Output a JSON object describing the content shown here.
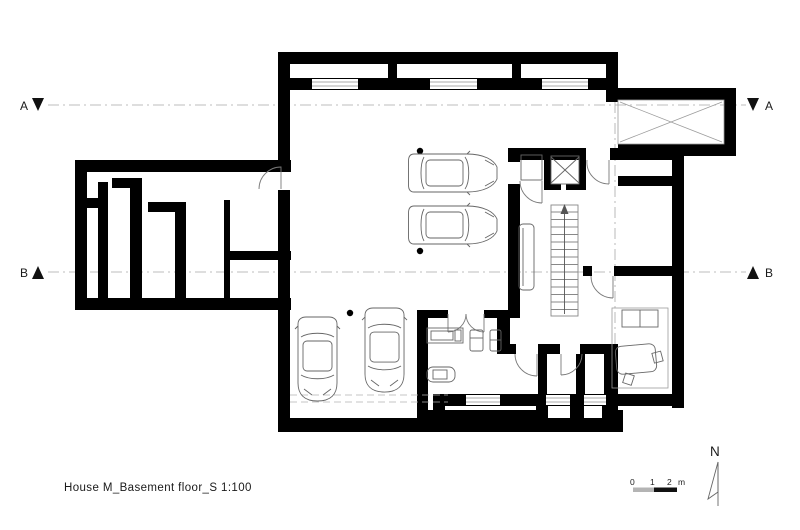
{
  "title_block": {
    "title": "House M_Basement floor_S 1:100"
  },
  "sections": {
    "a_left_label": "A",
    "a_right_label": "A",
    "b_left_label": "B",
    "b_right_label": "B"
  },
  "compass": {
    "label": "N"
  },
  "scale_bar": {
    "ticks": [
      "0",
      "1",
      "2"
    ],
    "unit": "m"
  },
  "icons": {
    "void_cross": "x-cross-void",
    "elevator": "elevator-x",
    "stairs": "stair-run-up-arrow",
    "section_triangle_down": "filled-triangle-down",
    "section_triangle_up": "filled-triangle-up"
  },
  "colors": {
    "wall": "#000000",
    "thin_line": "#666666",
    "light_line": "#9c9c9c",
    "section_line": "#a8a8a8",
    "scale_gray": "#b4b4b4",
    "scale_black": "#111111",
    "background": "#ffffff"
  }
}
